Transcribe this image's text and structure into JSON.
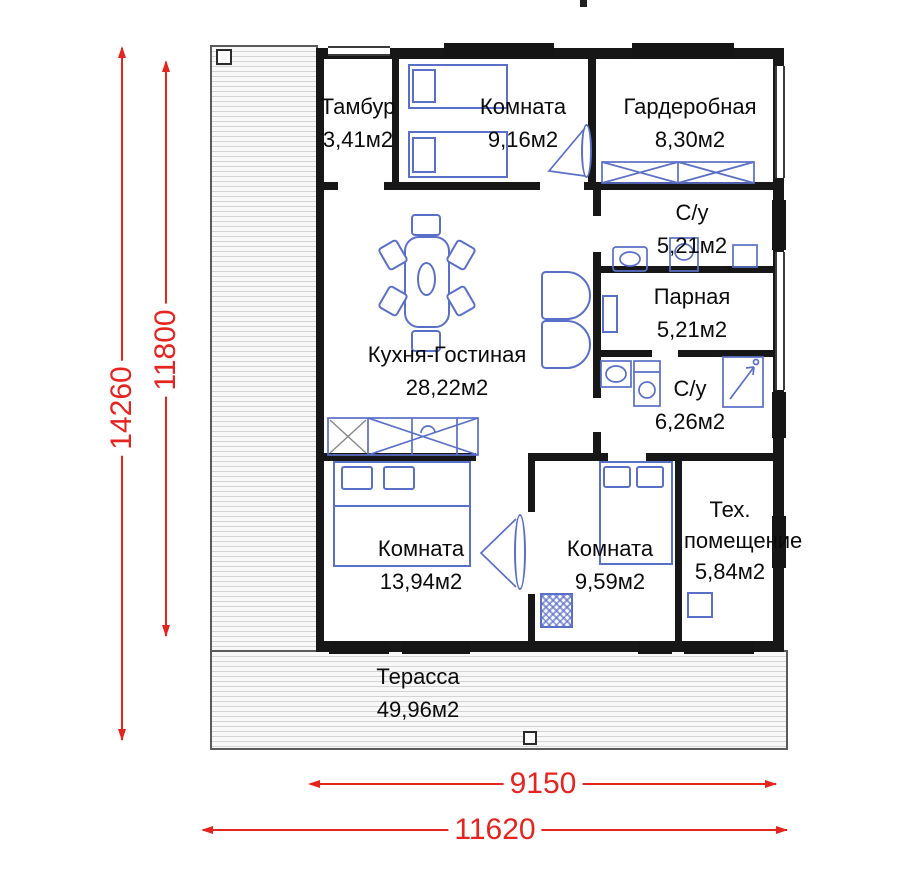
{
  "plan": {
    "rooms": [
      {
        "id": "tambur",
        "name": "Тамбур",
        "area": "3,41м2"
      },
      {
        "id": "bedroom-top",
        "name": "Комната",
        "area": "9,16м2"
      },
      {
        "id": "wardrobe-room",
        "name": "Гардеробная",
        "area": "8,30м2"
      },
      {
        "id": "bathroom-top",
        "name": "С/у",
        "area": "5,21м2"
      },
      {
        "id": "sauna",
        "name": "Парная",
        "area": "5,21м2"
      },
      {
        "id": "bathroom-bottom",
        "name": "С/у",
        "area": "6,26м2"
      },
      {
        "id": "kitchen-living",
        "name": "Кухня-Гостиная",
        "area": "28,22м2"
      },
      {
        "id": "bedroom-left",
        "name": "Комната",
        "area": "13,94м2"
      },
      {
        "id": "bedroom-mid",
        "name": "Комната",
        "area": "9,59м2"
      },
      {
        "id": "tech-room",
        "name": "Тех. помещение",
        "area": "5,84м2"
      },
      {
        "id": "terrace",
        "name": "Терасса",
        "area": "49,96м2"
      }
    ],
    "dimensions": {
      "total_height": "14260",
      "house_height": "11800",
      "house_width": "9150",
      "total_width": "11620"
    },
    "colors": {
      "dimension_red": "#e52420",
      "furniture_blue": "#5a6fc8",
      "wall_black": "#171717"
    }
  }
}
